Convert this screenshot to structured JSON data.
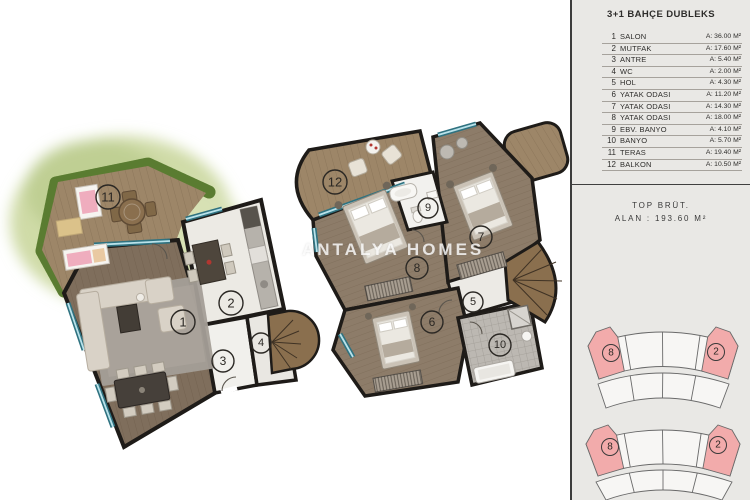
{
  "watermark": "ANTALYA HOMES",
  "legend": {
    "title": "3+1 BAHÇE DUBLEKS",
    "rooms": [
      {
        "no": "1",
        "name": "SALON",
        "area": "A: 36.00 M²"
      },
      {
        "no": "2",
        "name": "MUTFAK",
        "area": "A: 17.60 M²"
      },
      {
        "no": "3",
        "name": "ANTRE",
        "area": "A: 5.40 M²"
      },
      {
        "no": "4",
        "name": "WC",
        "area": "A: 2.00 M²"
      },
      {
        "no": "5",
        "name": "HOL",
        "area": "A: 4.30 M²"
      },
      {
        "no": "6",
        "name": "YATAK ODASI",
        "area": "A: 11.20 M²"
      },
      {
        "no": "7",
        "name": "YATAK ODASI",
        "area": "A: 14.30 M²"
      },
      {
        "no": "8",
        "name": "YATAK ODASI",
        "area": "A: 18.00 M²"
      },
      {
        "no": "9",
        "name": "EBV. BANYO",
        "area": "A: 4.10 M²"
      },
      {
        "no": "10",
        "name": "BANYO",
        "area": "A: 5.70 M²"
      },
      {
        "no": "11",
        "name": "TERAS",
        "area": "A: 19.40 M²"
      },
      {
        "no": "12",
        "name": "BALKON",
        "area": "A: 10.50 M²"
      }
    ]
  },
  "summary": {
    "line1": "TOP BRÜT.",
    "line2": "ALAN : 193.60 M²"
  },
  "plan_labels": {
    "ground": {
      "teras": "11",
      "salon": "1",
      "mutfak": "2",
      "antre": "3",
      "wc": "4"
    },
    "upper": {
      "balkon": "12",
      "yatak8": "8",
      "ebv_banyo": "9",
      "yatak7": "7",
      "hol": "5",
      "yatak6": "6",
      "banyo": "10"
    }
  },
  "site_plan": {
    "top_block": {
      "left_unit": "8",
      "right_unit": "2"
    },
    "bottom_block": {
      "left_unit": "8",
      "right_unit": "2"
    }
  },
  "colors": {
    "accent_pink": "#f2abab",
    "wall": "#1e1b18",
    "window_teal": "#2f7280",
    "panel_bg": "#e9e8e5",
    "hedge_green": "#6f9242"
  }
}
